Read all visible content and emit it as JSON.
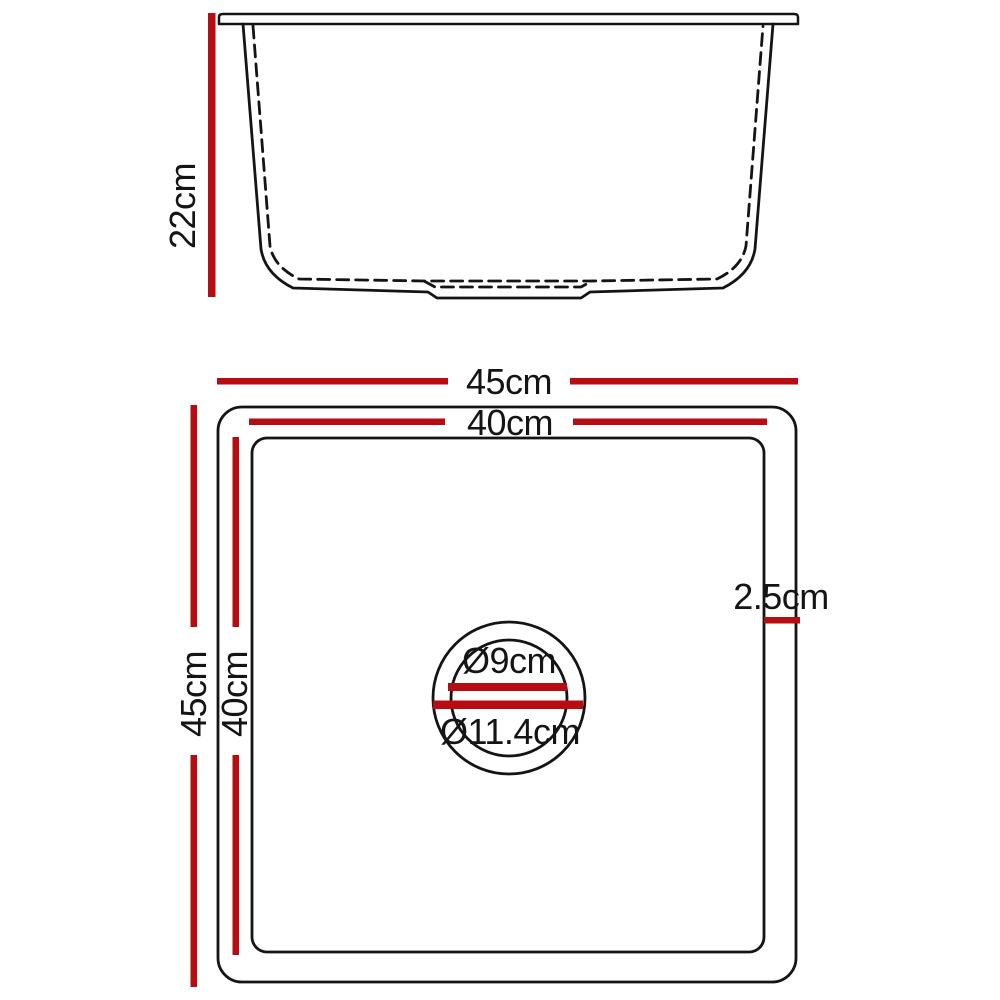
{
  "diagram": {
    "subject": "kitchen sink dimension drawing",
    "views": [
      "side elevation",
      "top view"
    ]
  },
  "colors": {
    "dimension_red": "#b50d11",
    "line_black": "#141414",
    "background": "#ffffff"
  },
  "side_view": {
    "height_label": "22cm"
  },
  "top_view": {
    "outer_width_label": "45cm",
    "inner_width_label": "40cm",
    "outer_depth_label": "45cm",
    "inner_depth_label": "40cm",
    "edge_thickness_label": "2.5cm",
    "drain_inner_diameter_label": "Ø9cm",
    "drain_outer_diameter_label": "Ø11.4cm"
  }
}
